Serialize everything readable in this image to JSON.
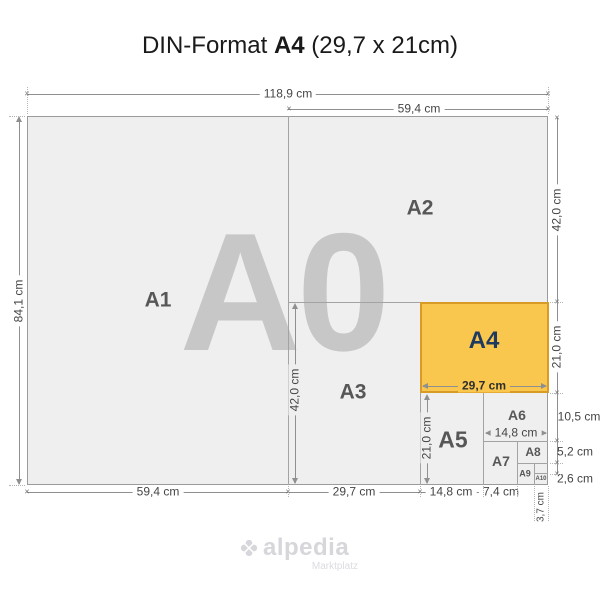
{
  "title": {
    "part1": "DIN-Format ",
    "part2": "A4",
    "part3": " (29,7 x 21cm)"
  },
  "regions": {
    "a0": "A0",
    "a1": "A1",
    "a2": "A2",
    "a3": "A3",
    "a4": "A4",
    "a5": "A5",
    "a6": "A6",
    "a7": "A7",
    "a8": "A8",
    "a9": "A9",
    "a10": "A10"
  },
  "dimensions": {
    "top_width": "118,9 cm",
    "top_right_width": "59,4 cm",
    "left_height": "84,1 cm",
    "right_a2_height": "42,0 cm",
    "right_a4_height": "21,0 cm",
    "right_a6_height": "10,5 cm",
    "right_a8_height": "5,2 cm",
    "right_a10_height": "2,6 cm",
    "bottom_a1_width": "59,4 cm",
    "bottom_a3_width": "29,7 cm",
    "bottom_a5_width": "14,8 cm",
    "bottom_a7_width": "7,4 cm",
    "bottom_a9_width": "3,7 cm",
    "inner_a3_height": "42,0 cm",
    "inner_a5_height": "21,0 cm",
    "inner_a4_width": "29,7 cm",
    "inner_a6_width": "14,8 cm"
  },
  "logo": {
    "name": "alpedia",
    "tagline": "Marktplatz"
  },
  "colors": {
    "a4_fill": "#F9C64E",
    "a4_border": "#D89B28",
    "a4_text": "#1E3A5F",
    "sheet_fill": "#EFEFEF",
    "watermark": "#C7C7C7",
    "dimension_line": "#8F8F8F"
  }
}
